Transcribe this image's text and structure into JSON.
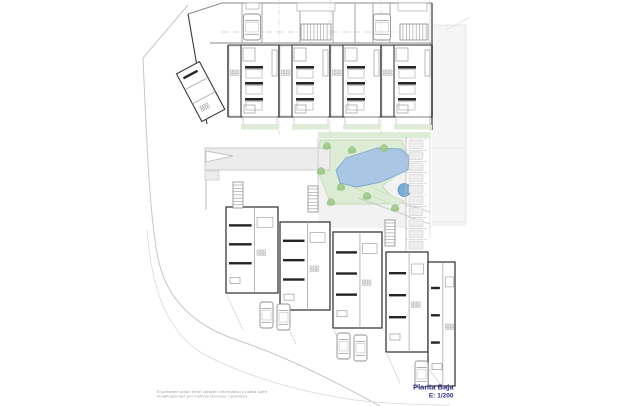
{
  "title_block": {
    "name": "Planta Baja",
    "scale": "E: 1/200"
  },
  "disclaimer": {
    "line1": "El presente plano tiene carácter informativo y podrá sufrir",
    "line2": "modificaciones por motivos técnicos o jurídicos."
  },
  "colors": {
    "navy": "#2b2e83",
    "muted": "#9a9a9a",
    "wall_dark": "#3a3a3a",
    "wall_black": "#242424",
    "wall_mid": "#8f8f8f",
    "line_light": "#c2c2c2",
    "pool": "#a9c7e4",
    "pool_edge": "#7fa8cc",
    "spa": "#79add9",
    "spa_edge": "#5d90bf",
    "lawn": "#ddecd4",
    "lawn_edge": "#bcd8ab",
    "tree": "#9fc98a",
    "tree_edge": "#7fb368",
    "path": "#ececec",
    "floor": "#f2f2f2",
    "parking": "#ededed",
    "parking_edge": "#cfcfcf"
  },
  "plan": {
    "canvas": {
      "w": 620,
      "h": 406
    },
    "top_building": {
      "left_edge": [
        188,
        14,
        207,
        124
      ],
      "top_edge": "M 188,14 L 222,3 L 432,3",
      "right_edge_x": 432,
      "garage_wall_y": 43,
      "garage_walls_x": [
        242,
        262,
        300,
        333,
        355,
        373,
        390
      ],
      "garage_dash_y": 32,
      "door_rects": [
        {
          "x": 246,
          "y": 3,
          "w": 13,
          "h": 6
        },
        {
          "x": 297,
          "y": 3,
          "w": 38,
          "h": 8
        },
        {
          "x": 398,
          "y": 3,
          "w": 29,
          "h": 8
        }
      ],
      "garage_cars": [
        {
          "x": 243.5,
          "y": 14
        },
        {
          "x": 373.5,
          "y": 14
        }
      ],
      "garage_car_size": {
        "w": 17,
        "h": 26
      },
      "top_stairs": [
        {
          "x": 301,
          "y": 24,
          "w": 30,
          "h": 16,
          "dir": "h"
        },
        {
          "x": 400,
          "y": 24,
          "w": 28,
          "h": 16,
          "dir": "h"
        }
      ],
      "units": {
        "count": 4,
        "x0": 228,
        "w": 51,
        "top": 45,
        "bottom": 117
      },
      "grid_lines_x": [
        279,
        330,
        381
      ],
      "tilted_unit": {
        "angle": -28,
        "cx": 202,
        "cy": 92,
        "x": 188,
        "y": 64,
        "w": 26,
        "h": 54
      }
    },
    "courtyard": {
      "floor": {
        "x": 318,
        "y": 138,
        "w": 88,
        "h": 90
      },
      "green_strip": {
        "x": 318,
        "y": 132,
        "w": 112,
        "h": 6
      },
      "lawn_points": "320,140 402,140 409,166 382,186 399,204 331,204 318,172",
      "pool_points": "336,170 346,158 377,148 401,149 409,156 408,170 381,182 357,187 340,183",
      "spa": {
        "cx": 404.5,
        "cy": 190,
        "r": 6.5
      },
      "green_band_points": "353,187 362,183 404,201 397,207",
      "trees": [
        [
          327,
          146
        ],
        [
          352,
          150
        ],
        [
          384,
          148
        ],
        [
          321,
          171
        ],
        [
          341,
          187
        ],
        [
          367,
          196
        ],
        [
          331,
          202
        ],
        [
          395,
          208
        ]
      ],
      "ramp": {
        "x": 205,
        "y": 148,
        "w": 125,
        "h": 22
      },
      "ramp_arrow": "206,151 206,162 233,156",
      "exit_lines": [
        [
          352,
          186,
          430,
          212
        ],
        [
          358,
          198,
          430,
          224
        ]
      ]
    },
    "parking": {
      "x": 406,
      "y": 139,
      "stall_w": 21,
      "stall_h": 11.2,
      "count": 10
    },
    "bottom_units": [
      {
        "x": 226,
        "y": 207,
        "w": 52,
        "h": 86
      },
      {
        "x": 280,
        "y": 222,
        "w": 50,
        "h": 88
      },
      {
        "x": 333,
        "y": 232,
        "w": 49,
        "h": 96
      },
      {
        "x": 386,
        "y": 252,
        "w": 42,
        "h": 100
      },
      {
        "x": 428,
        "y": 262,
        "w": 27,
        "h": 124
      }
    ],
    "stairs": [
      {
        "x": 233,
        "y": 182,
        "w": 10,
        "h": 26,
        "dir": "v"
      },
      {
        "x": 308,
        "y": 186,
        "w": 10,
        "h": 26,
        "dir": "v"
      },
      {
        "x": 385,
        "y": 220,
        "w": 10,
        "h": 26,
        "dir": "v"
      }
    ],
    "parcel_lines": [
      [
        226,
        293,
        243,
        330
      ],
      [
        280,
        310,
        296,
        344
      ],
      [
        333,
        328,
        348,
        360
      ],
      [
        386,
        352,
        400,
        383
      ],
      [
        428,
        368,
        443,
        387
      ]
    ],
    "street_cars": [
      [
        260,
        302
      ],
      [
        277,
        304
      ],
      [
        337,
        333
      ],
      [
        354,
        335
      ],
      [
        415,
        361
      ]
    ],
    "street_car_size": {
      "w": 13,
      "h": 26
    }
  }
}
